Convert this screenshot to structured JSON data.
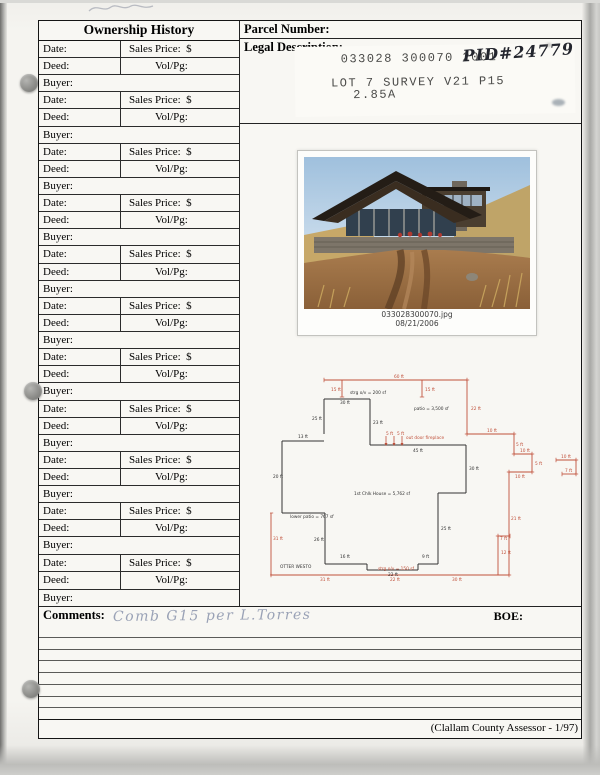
{
  "ownership_table": {
    "title": "Ownership History",
    "date_label": "Date:",
    "sales_label": "Sales Price:  $",
    "deed_label": "Deed:",
    "volpg_label": "Vol/Pg:",
    "buyer_label": "Buyer:",
    "group_count": 11
  },
  "parcel": {
    "parcel_number_label": "Parcel Number:",
    "legal_description_label": "Legal Description:",
    "stamp_line1": "033028 300070 2001",
    "stamp_line2": "LOT 7 SURVEY V21 P15",
    "stamp_line3": "2.85A",
    "pid_handwritten": "PID#24779"
  },
  "photo": {
    "caption_line1": "033028300070.jpg",
    "caption_line2": "08/21/2006"
  },
  "comments": {
    "label": "Comments:",
    "handwritten": "Comb G15 per L.Torres",
    "boe_label": "BOE:"
  },
  "footer": {
    "credit": "(Clallam County Assessor - 1/97)"
  },
  "sketch": {
    "red_color": "#c0503a",
    "black_color": "#333333",
    "labels": [
      {
        "t": "60 ft",
        "x": 124,
        "y": 10,
        "c": "r"
      },
      {
        "t": "15 ft",
        "x": 61,
        "y": 23,
        "c": "r"
      },
      {
        "t": "15 ft",
        "x": 155,
        "y": 23,
        "c": "r"
      },
      {
        "t": "22 ft",
        "x": 201,
        "y": 42,
        "c": "r"
      },
      {
        "t": "10 ft",
        "x": 217,
        "y": 64,
        "c": "r"
      },
      {
        "t": "5 ft",
        "x": 246,
        "y": 78,
        "c": "r"
      },
      {
        "t": "10 ft",
        "x": 250,
        "y": 84,
        "c": "r"
      },
      {
        "t": "5 ft",
        "x": 265,
        "y": 97,
        "c": "r"
      },
      {
        "t": "10 ft",
        "x": 245,
        "y": 110,
        "c": "r"
      },
      {
        "t": "21 ft",
        "x": 241,
        "y": 152,
        "c": "r"
      },
      {
        "t": "12 ft",
        "x": 231,
        "y": 186,
        "c": "r"
      },
      {
        "t": "7 ft",
        "x": 230,
        "y": 172,
        "c": "r"
      },
      {
        "t": "10 ft",
        "x": 291,
        "y": 90,
        "c": "r"
      },
      {
        "t": "7 ft",
        "x": 295,
        "y": 104,
        "c": "r"
      },
      {
        "t": "31 ft",
        "x": 50,
        "y": 213,
        "c": "r"
      },
      {
        "t": "22 ft",
        "x": 120,
        "y": 213,
        "c": "r"
      },
      {
        "t": "30 ft",
        "x": 182,
        "y": 213,
        "c": "r"
      },
      {
        "t": "31 ft",
        "x": 3,
        "y": 172,
        "c": "r"
      },
      {
        "t": "strg o/v = 150 sf",
        "x": 108,
        "y": 202,
        "c": "r"
      },
      {
        "t": "out door fireplace",
        "x": 136,
        "y": 71,
        "c": "r"
      },
      {
        "t": "5 ft",
        "x": 116,
        "y": 67,
        "c": "r"
      },
      {
        "t": "5 ft",
        "x": 127,
        "y": 67,
        "c": "r"
      },
      {
        "t": "30 ft",
        "x": 70,
        "y": 36,
        "c": "b"
      },
      {
        "t": "25 ft",
        "x": 42,
        "y": 52,
        "c": "b"
      },
      {
        "t": "23 ft",
        "x": 103,
        "y": 56,
        "c": "b"
      },
      {
        "t": "13 ft",
        "x": 28,
        "y": 70,
        "c": "b"
      },
      {
        "t": "20 ft",
        "x": 3,
        "y": 110,
        "c": "b"
      },
      {
        "t": "26 ft",
        "x": 44,
        "y": 173,
        "c": "b"
      },
      {
        "t": "45 ft",
        "x": 143,
        "y": 84,
        "c": "b"
      },
      {
        "t": "30 ft",
        "x": 199,
        "y": 102,
        "c": "b"
      },
      {
        "t": "25 ft",
        "x": 171,
        "y": 162,
        "c": "b"
      },
      {
        "t": "16 ft",
        "x": 70,
        "y": 190,
        "c": "b"
      },
      {
        "t": "22 ft",
        "x": 118,
        "y": 208,
        "c": "b"
      },
      {
        "t": "9 ft",
        "x": 152,
        "y": 190,
        "c": "b"
      },
      {
        "t": "strg o/v = 200 sf",
        "x": 80,
        "y": 26,
        "c": "b"
      },
      {
        "t": "patio = 3,500 sf",
        "x": 144,
        "y": 42,
        "c": "b"
      },
      {
        "t": "1st Chlk House = 5,762 sf",
        "x": 84,
        "y": 127,
        "c": "b"
      },
      {
        "t": "lower patio = 767 sf",
        "x": 20,
        "y": 150,
        "c": "b"
      },
      {
        "t": "OTTER WESTO",
        "x": 10,
        "y": 200,
        "c": "b"
      }
    ]
  }
}
